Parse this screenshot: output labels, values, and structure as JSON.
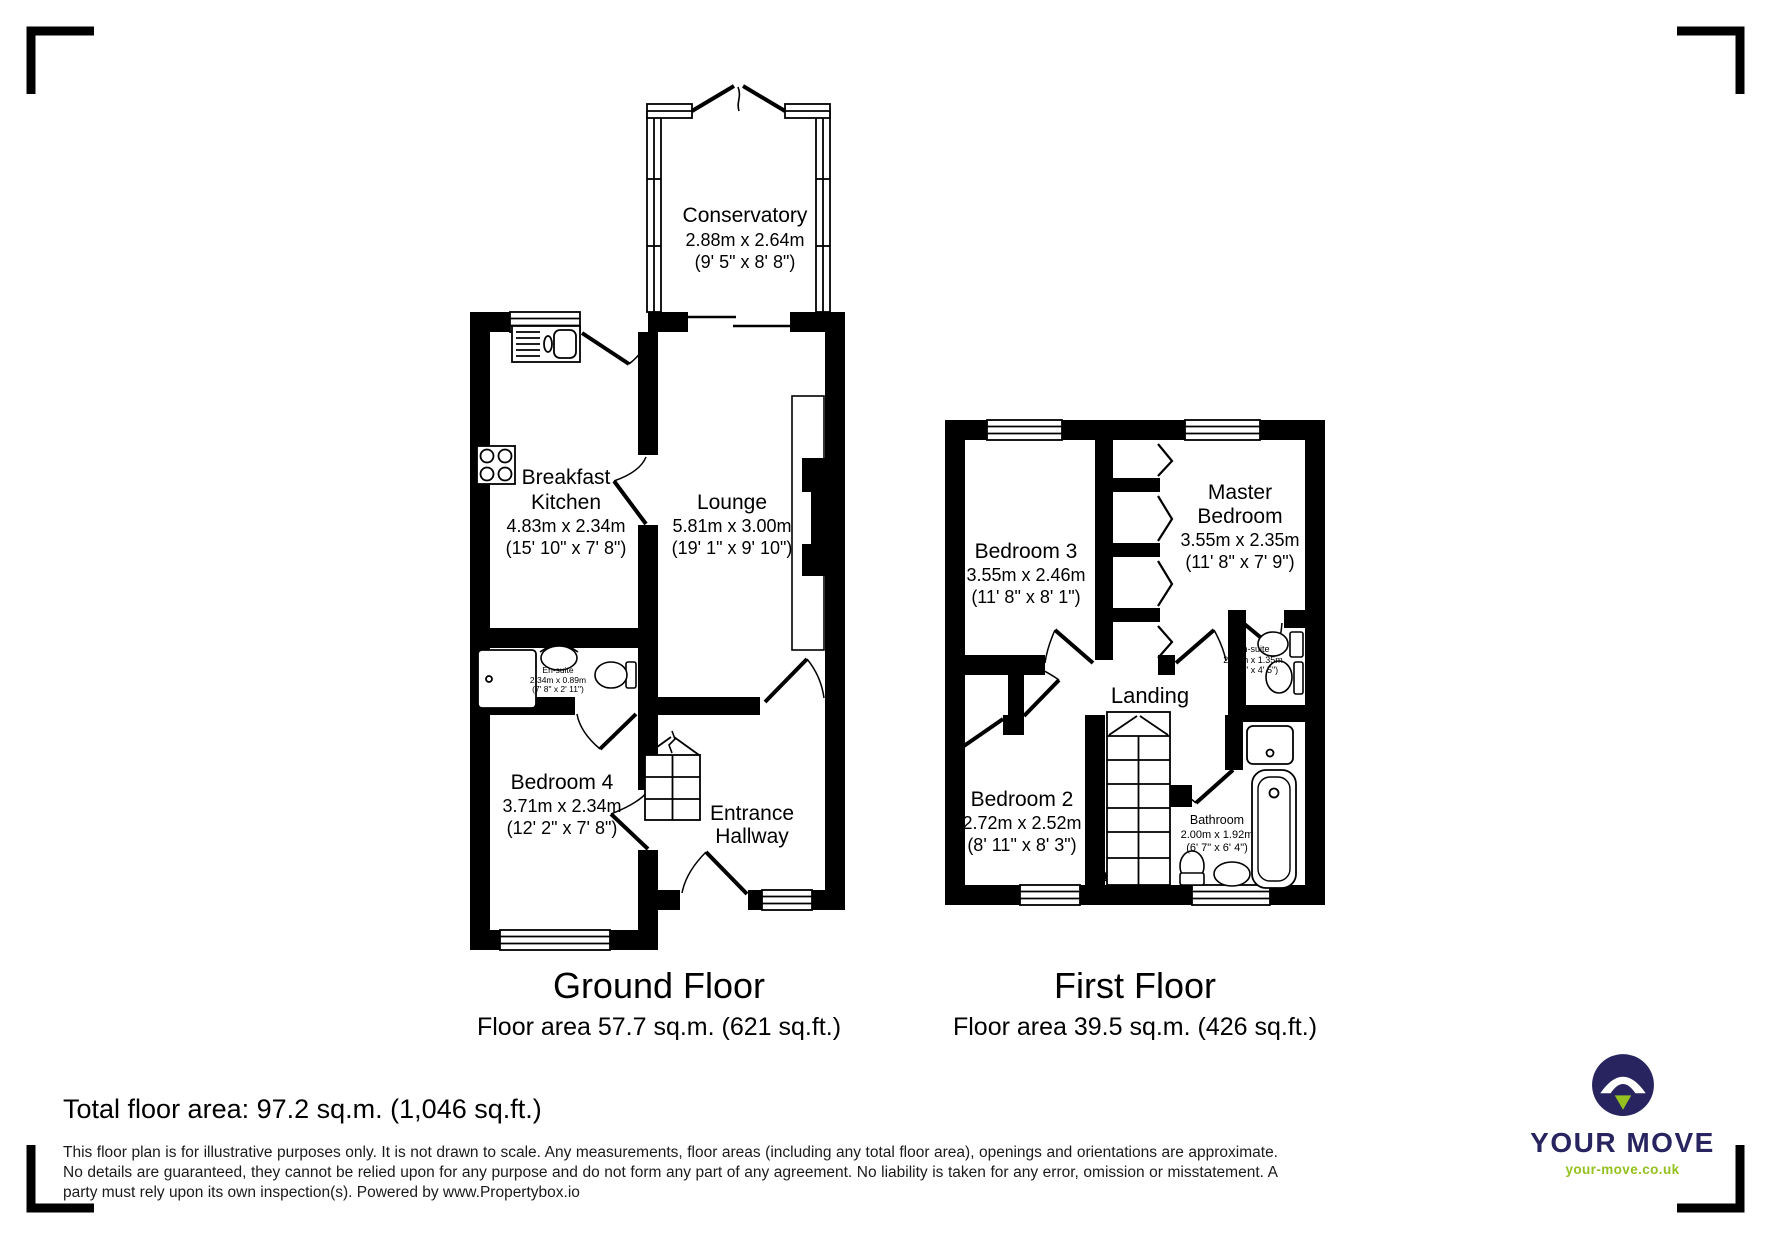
{
  "ground_floor": {
    "title": "Ground Floor",
    "area": "Floor area 57.7 sq.m. (621 sq.ft.)",
    "conservatory": {
      "name": "Conservatory",
      "metric": "2.88m x 2.64m",
      "imperial": "(9' 5\" x 8' 8\")"
    },
    "kitchen": {
      "line1": "Breakfast",
      "line2": "Kitchen",
      "metric": "4.83m x 2.34m",
      "imperial": "(15' 10\" x 7' 8\")"
    },
    "lounge": {
      "name": "Lounge",
      "metric": "5.81m x 3.00m",
      "imperial": "(19' 1\" x 9' 10\")"
    },
    "ensuite": {
      "name": "En-suite",
      "metric": "2.34m x 0.89m",
      "imperial": "(7' 8\" x 2' 11\")"
    },
    "bedroom4": {
      "name": "Bedroom 4",
      "metric": "3.71m x 2.34m",
      "imperial": "(12' 2\" x 7' 8\")"
    },
    "hallway": {
      "line1": "Entrance",
      "line2": "Hallway"
    }
  },
  "first_floor": {
    "title": "First Floor",
    "area": "Floor area 39.5 sq.m. (426 sq.ft.)",
    "bedroom3": {
      "name": "Bedroom 3",
      "metric": "3.55m x 2.46m",
      "imperial": "(11' 8\" x 8' 1\")"
    },
    "master": {
      "line1": "Master",
      "line2": "Bedroom",
      "metric": "3.55m x 2.35m",
      "imperial": "(11' 8\" x 7' 9\")"
    },
    "ensuite": {
      "name": "En-suite",
      "metric": "2.34m x 1.35m",
      "imperial": "(7' 8\" x 4' 5\")"
    },
    "landing": {
      "name": "Landing"
    },
    "bedroom2": {
      "name": "Bedroom 2",
      "metric": "2.72m x 2.52m",
      "imperial": "(8' 11\" x 8' 3\")"
    },
    "bathroom": {
      "name": "Bathroom",
      "metric": "2.00m x 1.92m",
      "imperial": "(6' 7\" x 6' 4\")"
    }
  },
  "footer": {
    "total_area": "Total floor area: 97.2 sq.m. (1,046 sq.ft.)",
    "disclaimer": "This floor plan is for illustrative purposes only. It is not drawn to scale. Any measurements, floor areas (including any total floor area), openings and orientations are approximate. No details are guaranteed, they cannot be relied upon for any purpose and do not form any part of any agreement. No liability is taken for any error, omission or misstatement. A party must rely upon its own inspection(s). Powered by www.Propertybox.io"
  },
  "brand": {
    "name": "YOUR MOVE",
    "url": "your-move.co.uk",
    "navy": "#27245f",
    "green": "#94c11f"
  }
}
